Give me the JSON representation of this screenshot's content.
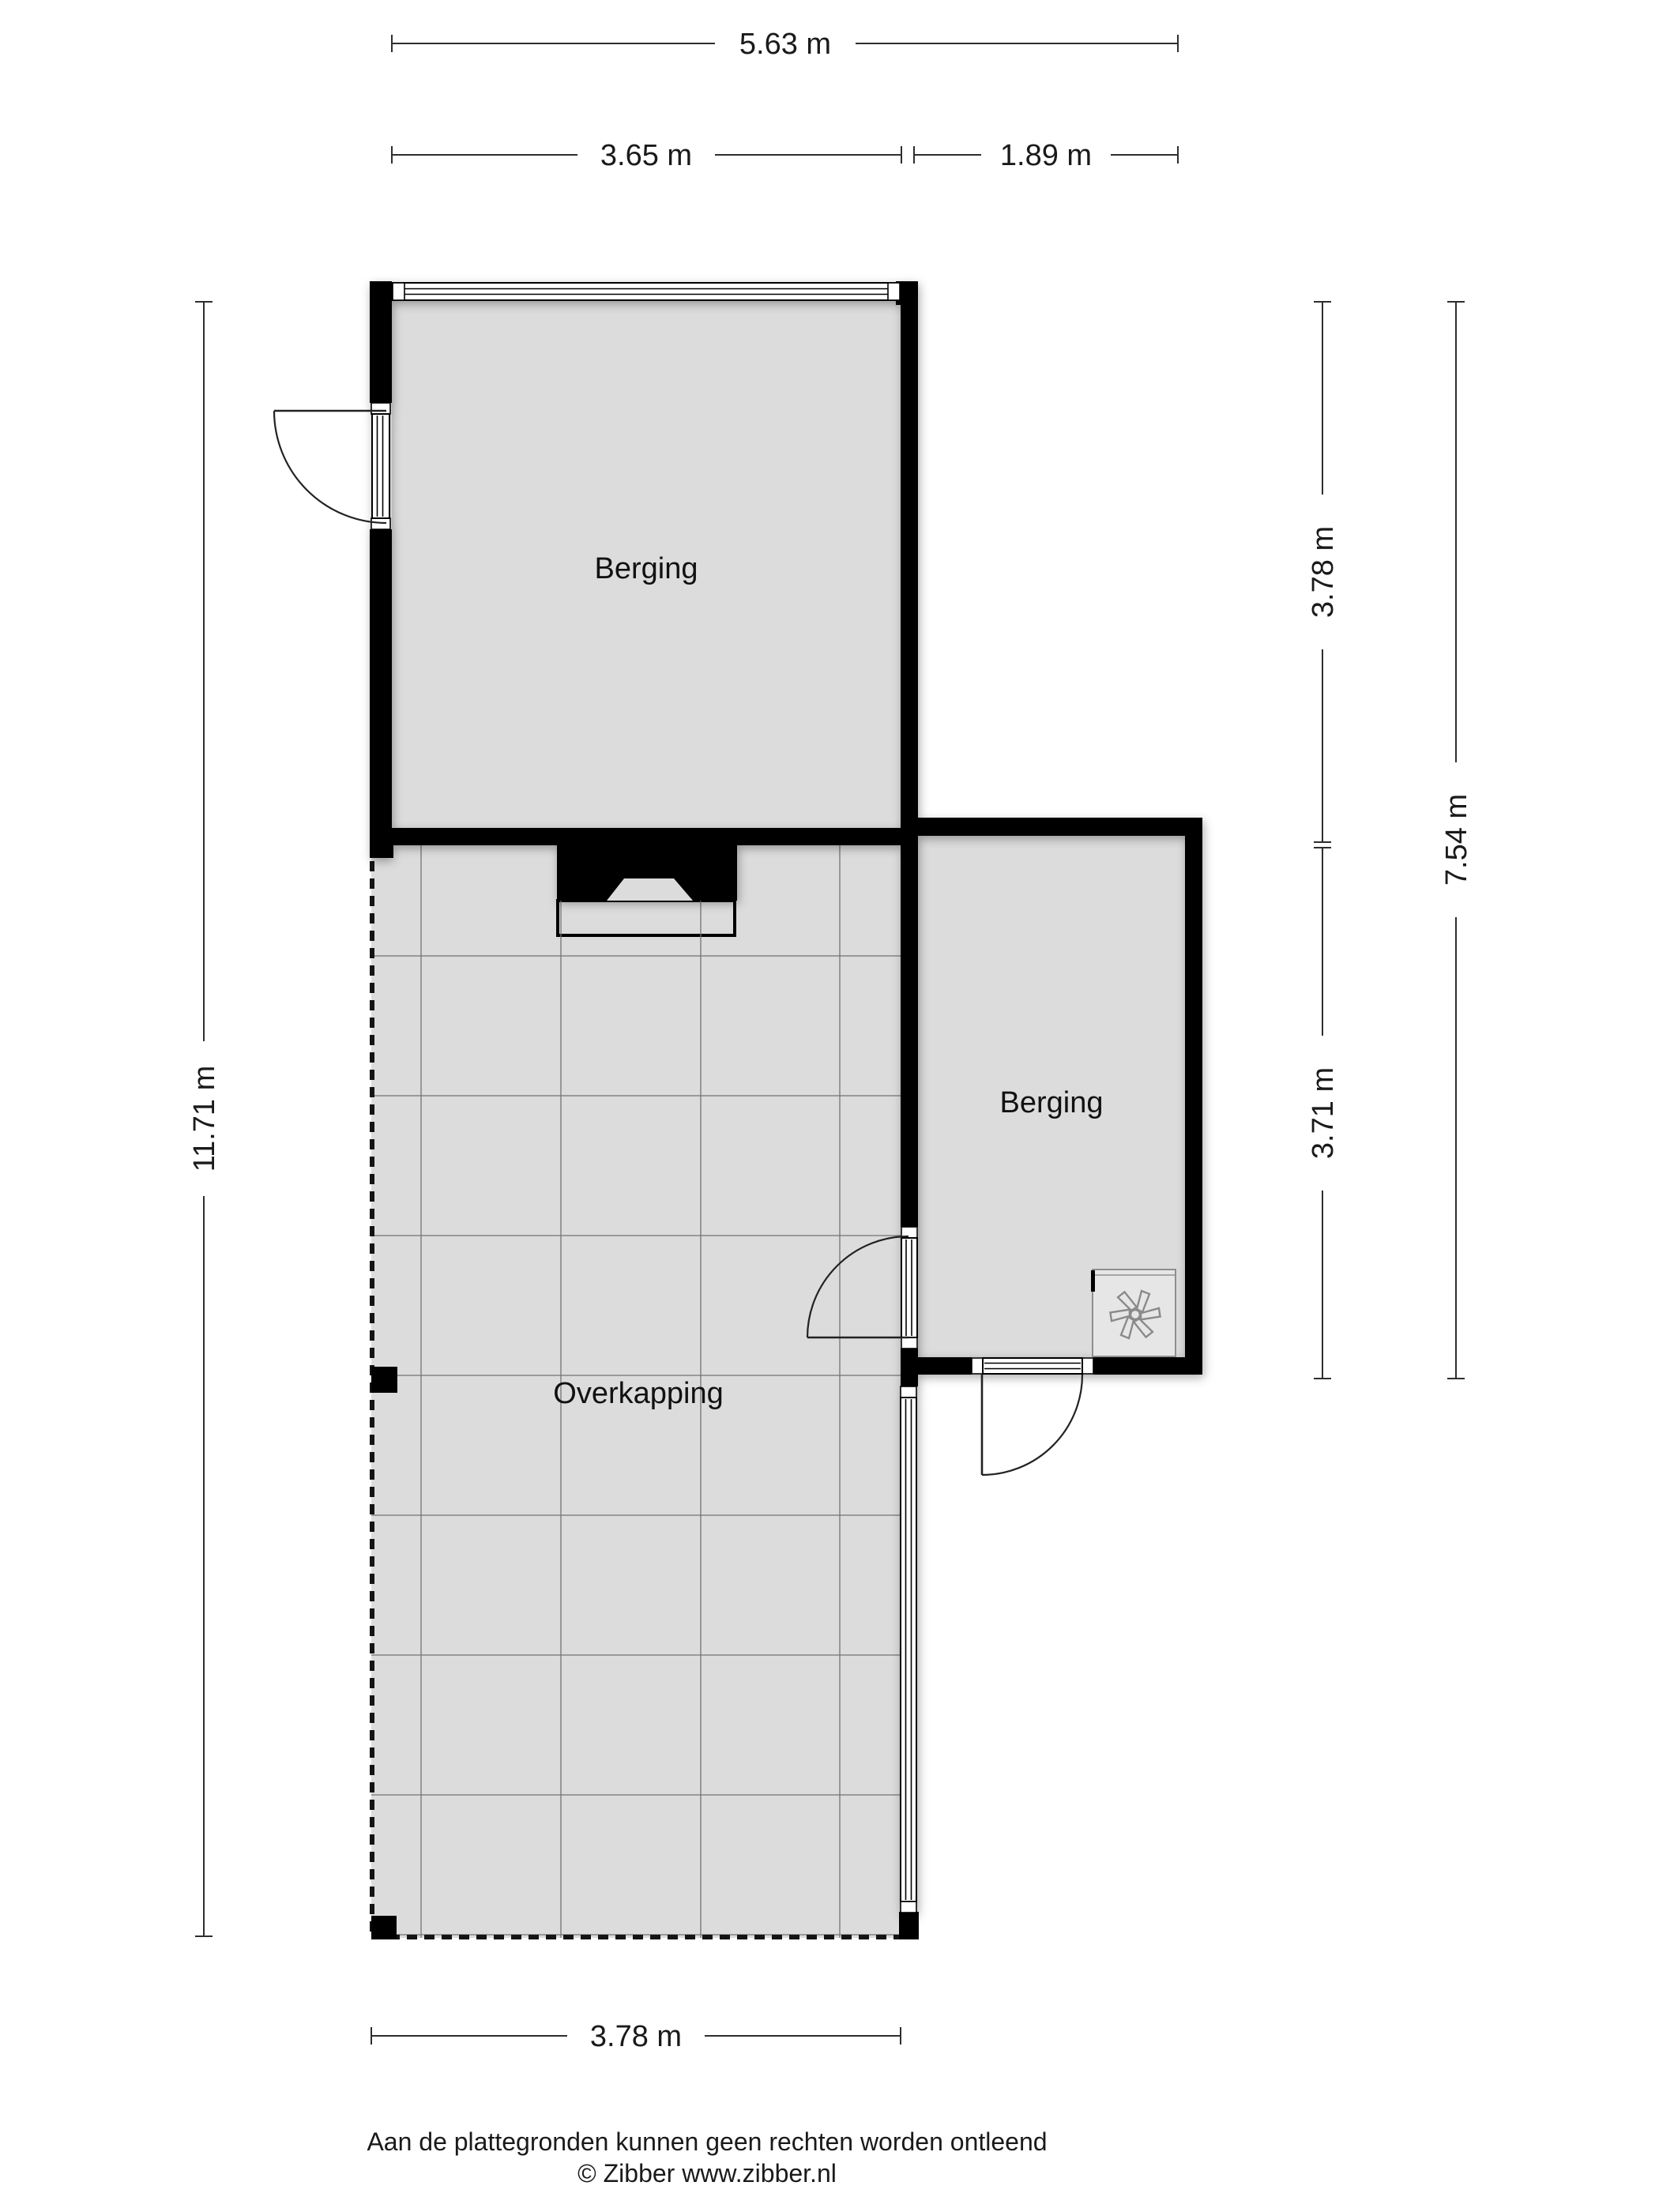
{
  "plan": {
    "type": "floorplan",
    "rooms": [
      {
        "id": "berging-1",
        "label": "Berging"
      },
      {
        "id": "berging-2",
        "label": "Berging"
      },
      {
        "id": "overkapping",
        "label": "Overkapping"
      }
    ],
    "dimensions": {
      "top_total": "5.63 m",
      "top_berging1": "3.65 m",
      "top_berging2": "1.89 m",
      "left_total": "11.71 m",
      "right_berging1": "3.78 m",
      "right_berging2": "3.71 m",
      "right_total": "7.54 m",
      "bottom_overkapping": "3.78 m"
    },
    "icons": {
      "ventilation": "fan-icon"
    },
    "colors": {
      "wall": "#000000",
      "floor": "#dcdcdc",
      "grid": "#737373",
      "dimension_text": "#1a1a1a",
      "fan_outline": "#8a8a8a",
      "background": "#ffffff"
    }
  },
  "footer": {
    "disclaimer": "Aan de plattegronden kunnen geen rechten worden ontleend",
    "copyright": "© Zibber www.zibber.nl"
  }
}
